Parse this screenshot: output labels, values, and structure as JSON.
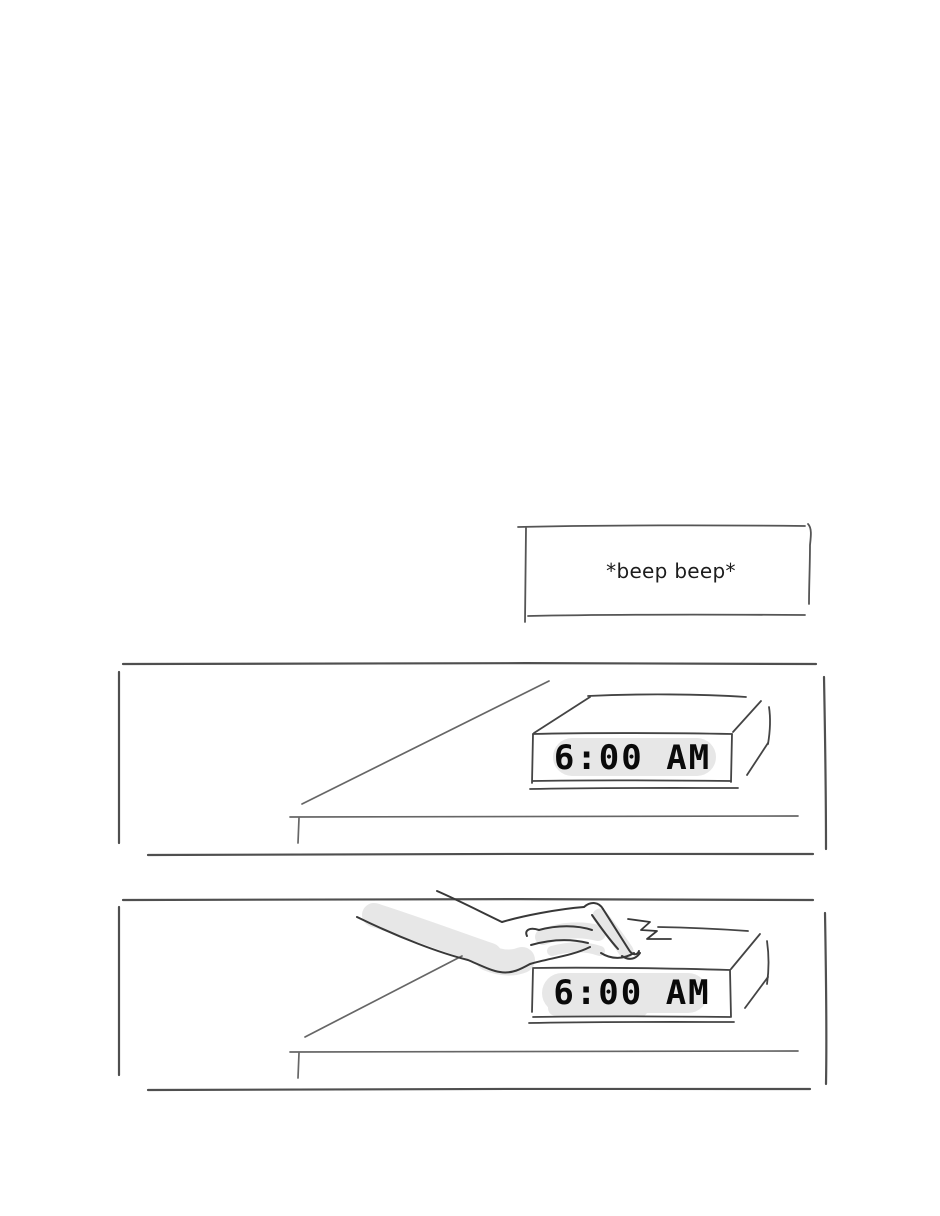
{
  "comic": {
    "caption": {
      "sfx_text": "*beep beep*"
    },
    "panel1": {
      "clock_display": "6:00 AM"
    },
    "panel2": {
      "clock_display": "6:00 AM"
    }
  },
  "colors": {
    "background": "#ffffff",
    "panel_border": "#4f4f4f",
    "table_ink": "#666666",
    "clock_ink": "#444444",
    "hand_ink": "#383838",
    "shade": "#e7e7e7",
    "clock_text": "#0a0a0a"
  }
}
